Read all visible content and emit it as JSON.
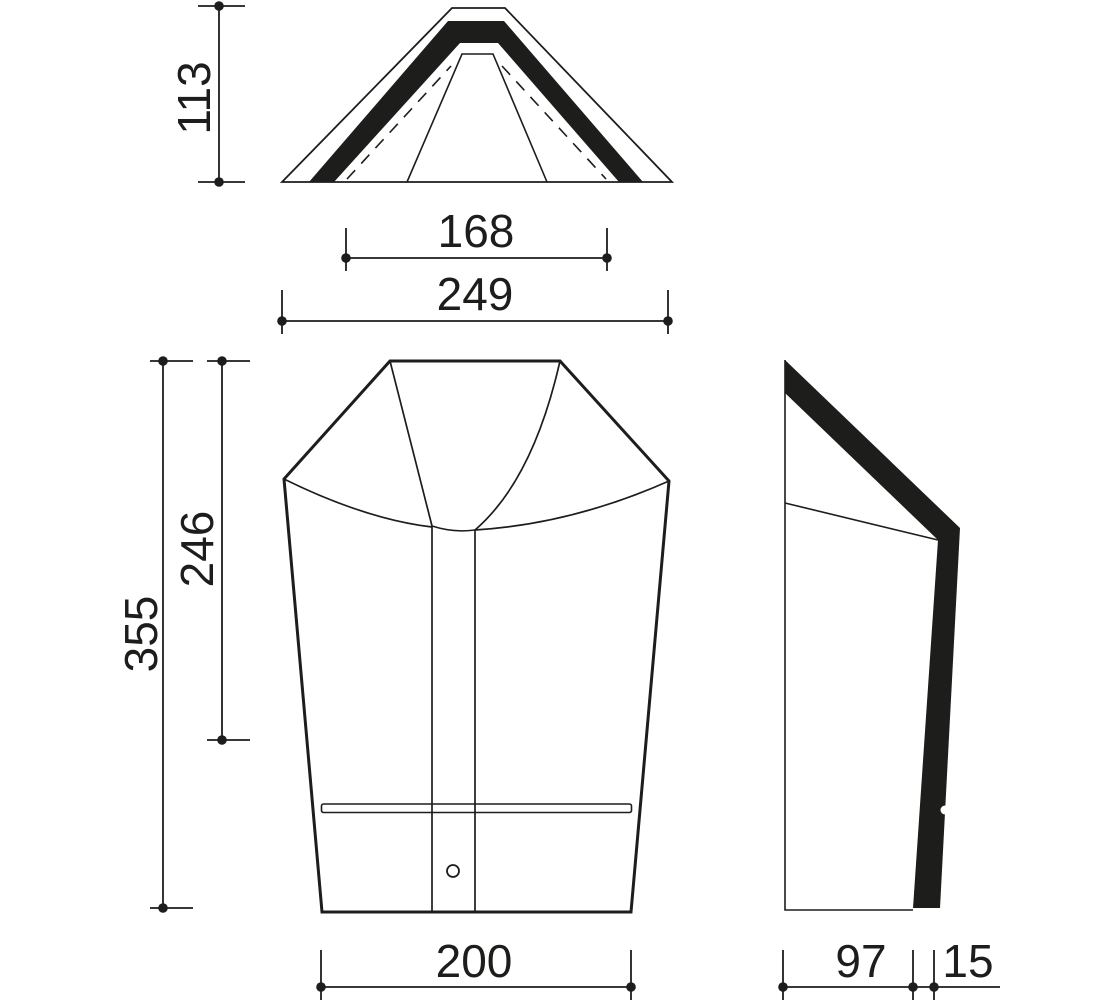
{
  "drawing": {
    "description": "Ridge tile technical drawing with three orthographic views and dimensions",
    "views": {
      "top": {
        "height": "113",
        "inner_width": "168",
        "outer_width": "249"
      },
      "front": {
        "total_height": "355",
        "upper_height": "246",
        "bottom_width": "200"
      },
      "side": {
        "depth": "97",
        "thickness": "15"
      }
    },
    "colors": {
      "line": "#1d1d1b",
      "tile_light": "#eec3a3",
      "tile_dark": "#d99f79"
    }
  }
}
